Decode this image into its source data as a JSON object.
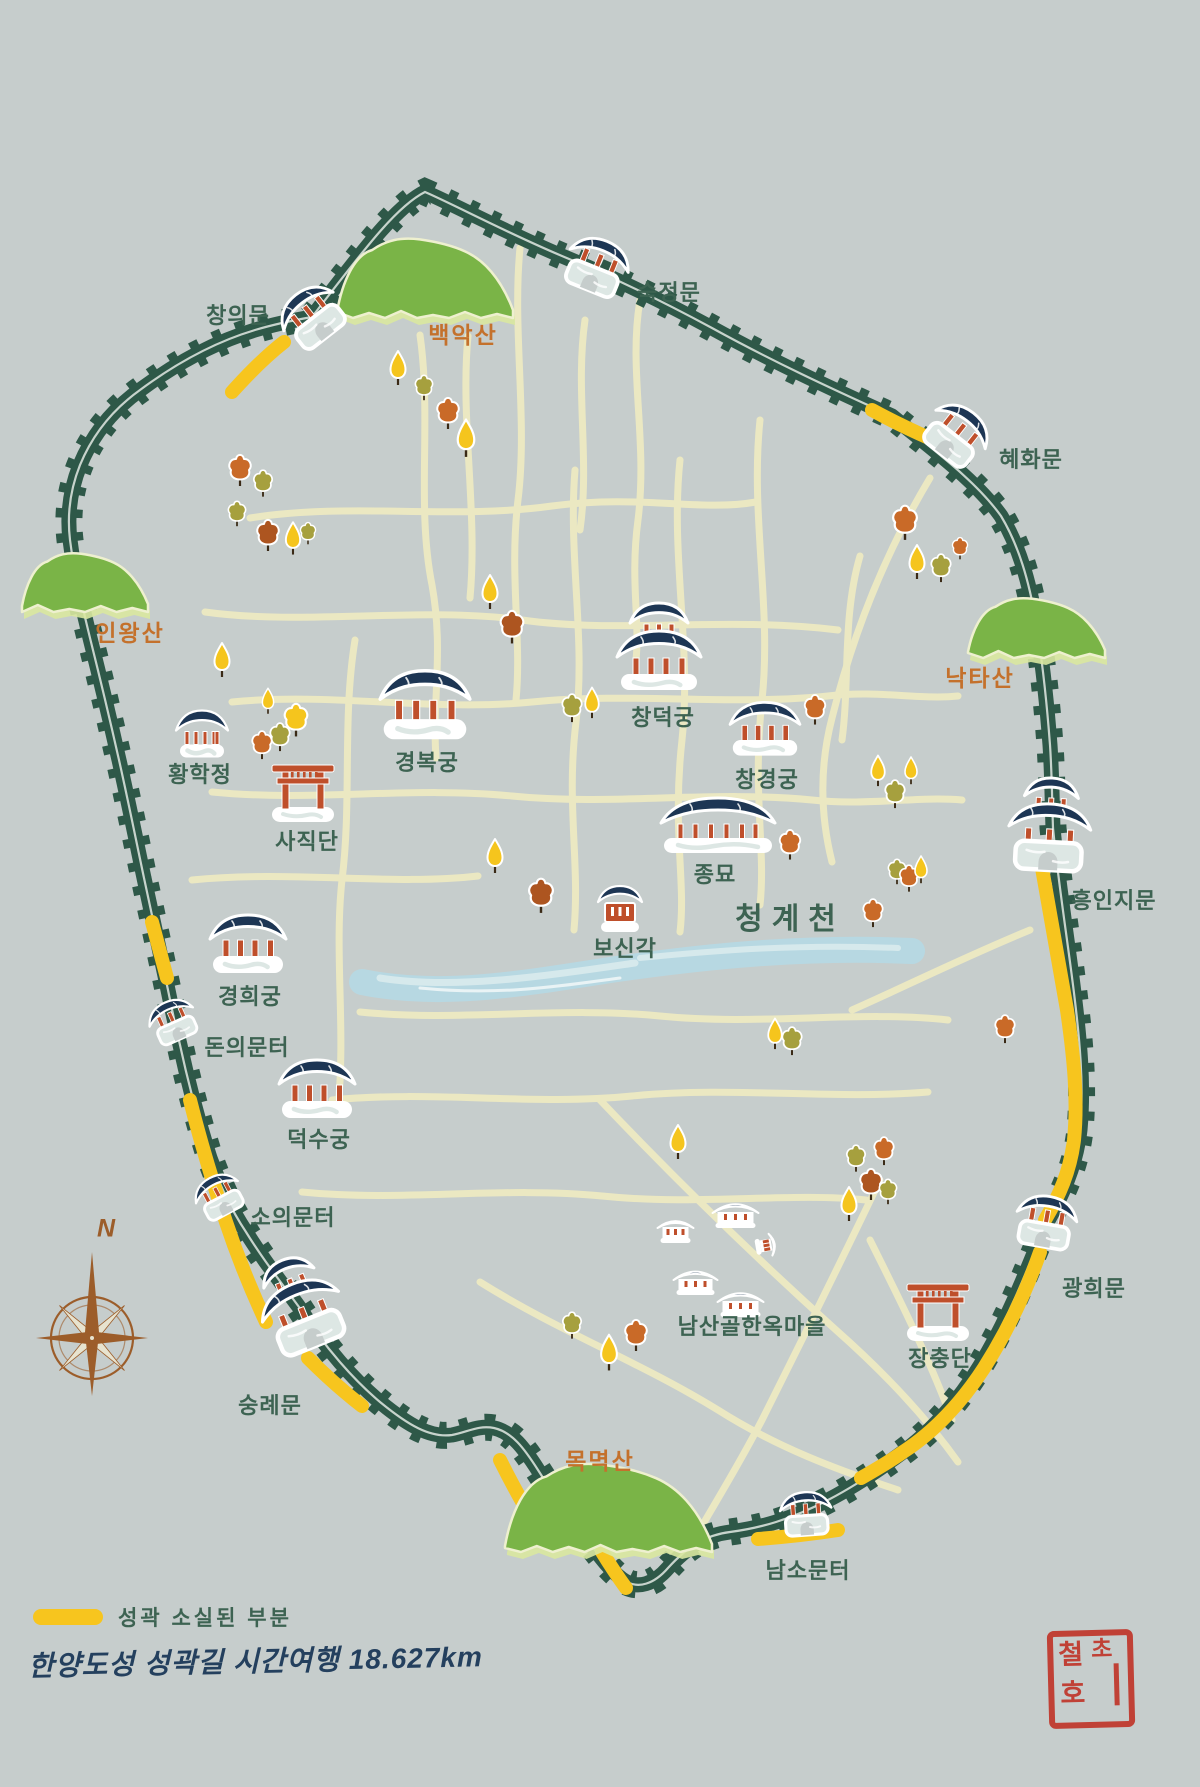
{
  "title": {
    "text": "한양도성 성곽길 시간여행 18.627km"
  },
  "legend": {
    "lost_label": "성곽 소실된 부분"
  },
  "compass": {
    "label": "N"
  },
  "seal": {
    "char1": "철",
    "char2": "초",
    "char3": "호"
  },
  "colors": {
    "bg": "#c6cdcc",
    "wall": "#2e5848",
    "lost": "#f7c51e",
    "road": "#ebe8c2",
    "stream": "#b7d8e2",
    "streamLight": "#d6e9ec",
    "mountain": "#7ab447",
    "mountainLight": "#d9e8a0",
    "mountainEdge": "#eef0cf",
    "roof": "#1d3654",
    "pillar": "#bf4f2b",
    "gateBase": "#dde7e4",
    "labelGreen": "#3d6352",
    "labelOrange": "#c4712c",
    "title": "#24405e",
    "sealRed": "#c03a2e",
    "treeYellow": "#f5c51d",
    "treeOrange": "#c96a28",
    "treeBrown": "#ad5520",
    "treeOlive": "#a6a03e",
    "compassBrown": "#9c5d2a"
  },
  "map": {
    "landmarks": [
      {
        "id": "changuimun",
        "label": "창의문",
        "type": "gate1",
        "icon": {
          "x": 312,
          "y": 316,
          "rot": -38,
          "s": 0.95
        },
        "label_pos": {
          "x": 238,
          "y": 314
        },
        "style": "green"
      },
      {
        "id": "sukjeongmun",
        "label": "숙정문",
        "type": "gate1",
        "icon": {
          "x": 597,
          "y": 266,
          "rot": 22,
          "s": 0.95
        },
        "label_pos": {
          "x": 669,
          "y": 291
        },
        "style": "green"
      },
      {
        "id": "hyehwamun",
        "label": "혜화문",
        "type": "gate1",
        "icon": {
          "x": 957,
          "y": 434,
          "rot": 38,
          "s": 0.95
        },
        "label_pos": {
          "x": 1031,
          "y": 458
        },
        "style": "green"
      },
      {
        "id": "heunginjimun",
        "label": "흥인지문",
        "type": "gate2",
        "icon": {
          "x": 1050,
          "y": 824,
          "rot": 3,
          "s": 1
        },
        "label_pos": {
          "x": 1114,
          "y": 899
        },
        "style": "green"
      },
      {
        "id": "gwanghuimun",
        "label": "광희문",
        "type": "gate1",
        "icon": {
          "x": 1046,
          "y": 1222,
          "rot": 10,
          "s": 0.92
        },
        "label_pos": {
          "x": 1094,
          "y": 1287
        },
        "style": "green"
      },
      {
        "id": "namsomunteo",
        "label": "남소문터",
        "type": "gate1",
        "icon": {
          "x": 806,
          "y": 1514,
          "rot": -4,
          "s": 0.78
        },
        "label_pos": {
          "x": 808,
          "y": 1569
        },
        "style": "green"
      },
      {
        "id": "sungnyemun",
        "label": "숭례문",
        "type": "gate2",
        "icon": {
          "x": 299,
          "y": 1303,
          "rot": -22,
          "s": 1
        },
        "label_pos": {
          "x": 270,
          "y": 1404
        },
        "style": "green"
      },
      {
        "id": "souimunteo",
        "label": "소의문터",
        "type": "gate1",
        "icon": {
          "x": 219,
          "y": 1196,
          "rot": -28,
          "s": 0.72
        },
        "label_pos": {
          "x": 293,
          "y": 1216
        },
        "style": "green"
      },
      {
        "id": "donuimunteo",
        "label": "돈의문터",
        "type": "gate1",
        "icon": {
          "x": 173,
          "y": 1021,
          "rot": -24,
          "s": 0.72
        },
        "label_pos": {
          "x": 247,
          "y": 1046
        },
        "style": "green"
      },
      {
        "id": "gyeongbokgung",
        "label": "경복궁",
        "type": "palace1",
        "icon": {
          "x": 425,
          "y": 705,
          "rot": 0,
          "s": 1.18
        },
        "label_pos": {
          "x": 427,
          "y": 761
        },
        "style": "green"
      },
      {
        "id": "changdeokgung",
        "label": "창덕궁",
        "type": "palace2",
        "icon": {
          "x": 659,
          "y": 646,
          "rot": 0,
          "s": 1
        },
        "label_pos": {
          "x": 663,
          "y": 716
        },
        "style": "green"
      },
      {
        "id": "changgyeonggung",
        "label": "창경궁",
        "type": "palace1",
        "icon": {
          "x": 765,
          "y": 729,
          "rot": 0,
          "s": 0.92
        },
        "label_pos": {
          "x": 767,
          "y": 778
        },
        "style": "green"
      },
      {
        "id": "jongmyo",
        "label": "종묘",
        "type": "jongmyo",
        "icon": {
          "x": 718,
          "y": 825,
          "rot": 0,
          "s": 1
        },
        "label_pos": {
          "x": 715,
          "y": 873
        },
        "style": "green"
      },
      {
        "id": "bosingak",
        "label": "보신각",
        "type": "bosingak",
        "icon": {
          "x": 620,
          "y": 909,
          "rot": 0,
          "s": 1
        },
        "label_pos": {
          "x": 625,
          "y": 947
        },
        "style": "green"
      },
      {
        "id": "cheonggyecheon",
        "label": "청계천",
        "type": null,
        "icon": null,
        "label_pos": {
          "x": 790,
          "y": 916
        },
        "style": "big"
      },
      {
        "id": "gyeonghuigung",
        "label": "경희궁",
        "type": "palace1",
        "icon": {
          "x": 248,
          "y": 944,
          "rot": 0,
          "s": 1
        },
        "label_pos": {
          "x": 250,
          "y": 995
        },
        "style": "green"
      },
      {
        "id": "deoksugung",
        "label": "덕수궁",
        "type": "palace1",
        "icon": {
          "x": 317,
          "y": 1089,
          "rot": 0,
          "s": 1
        },
        "label_pos": {
          "x": 319,
          "y": 1138
        },
        "style": "green"
      },
      {
        "id": "hwanghakjeong",
        "label": "황학정",
        "type": "hwanghak",
        "icon": {
          "x": 202,
          "y": 734,
          "rot": 0,
          "s": 1
        },
        "label_pos": {
          "x": 200,
          "y": 773
        },
        "style": "green"
      },
      {
        "id": "sajikdan",
        "label": "사직단",
        "type": "torii",
        "icon": {
          "x": 303,
          "y": 792,
          "rot": 0,
          "s": 1
        },
        "label_pos": {
          "x": 307,
          "y": 840
        },
        "style": "green"
      },
      {
        "id": "jangchungdan",
        "label": "장충단",
        "type": "torii",
        "icon": {
          "x": 938,
          "y": 1311,
          "rot": 0,
          "s": 1
        },
        "label_pos": {
          "x": 940,
          "y": 1357
        },
        "style": "green"
      },
      {
        "id": "namsangol-hanok-village",
        "label": "남산골한옥마을",
        "type": "village",
        "icon": {
          "x": 718,
          "y": 1252,
          "rot": 0,
          "s": 1
        },
        "label_pos": {
          "x": 752,
          "y": 1325
        },
        "style": "green"
      },
      {
        "id": "bugaksan",
        "label": "백악산",
        "type": null,
        "icon": null,
        "label_pos": {
          "x": 463,
          "y": 333
        },
        "style": "orange"
      },
      {
        "id": "inwangsan",
        "label": "인왕산",
        "type": null,
        "icon": null,
        "label_pos": {
          "x": 130,
          "y": 631
        },
        "style": "orange"
      },
      {
        "id": "naktasan",
        "label": "낙타산",
        "type": null,
        "icon": null,
        "label_pos": {
          "x": 980,
          "y": 676
        },
        "style": "orange"
      },
      {
        "id": "mongmyeoksan",
        "label": "목멱산",
        "type": null,
        "icon": null,
        "label_pos": {
          "x": 600,
          "y": 1459
        },
        "style": "orange"
      }
    ],
    "trees": [
      {
        "x": 398,
        "y": 376,
        "c": "yellow",
        "f": "point",
        "s": 1
      },
      {
        "x": 424,
        "y": 393,
        "c": "olive",
        "f": "round",
        "s": 0.8
      },
      {
        "x": 448,
        "y": 420,
        "c": "orange",
        "f": "round",
        "s": 1
      },
      {
        "x": 466,
        "y": 447,
        "c": "yellow",
        "f": "point",
        "s": 1.1
      },
      {
        "x": 240,
        "y": 477,
        "c": "orange",
        "f": "round",
        "s": 1
      },
      {
        "x": 263,
        "y": 489,
        "c": "olive",
        "f": "round",
        "s": 0.85
      },
      {
        "x": 237,
        "y": 519,
        "c": "olive",
        "f": "round",
        "s": 0.8
      },
      {
        "x": 268,
        "y": 542,
        "c": "brown",
        "f": "round",
        "s": 1
      },
      {
        "x": 293,
        "y": 546,
        "c": "yellow",
        "f": "point",
        "s": 0.95
      },
      {
        "x": 308,
        "y": 538,
        "c": "olive",
        "f": "round",
        "s": 0.7
      },
      {
        "x": 222,
        "y": 668,
        "c": "yellow",
        "f": "point",
        "s": 1
      },
      {
        "x": 268,
        "y": 707,
        "c": "yellow",
        "f": "point",
        "s": 0.75
      },
      {
        "x": 296,
        "y": 727,
        "c": "yellow",
        "f": "round",
        "s": 1.05
      },
      {
        "x": 280,
        "y": 743,
        "c": "olive",
        "f": "round",
        "s": 0.9
      },
      {
        "x": 262,
        "y": 751,
        "c": "orange",
        "f": "round",
        "s": 0.9
      },
      {
        "x": 490,
        "y": 600,
        "c": "yellow",
        "f": "point",
        "s": 1
      },
      {
        "x": 512,
        "y": 634,
        "c": "brown",
        "f": "round",
        "s": 1.05
      },
      {
        "x": 572,
        "y": 714,
        "c": "olive",
        "f": "round",
        "s": 0.9
      },
      {
        "x": 592,
        "y": 710,
        "c": "yellow",
        "f": "point",
        "s": 0.9
      },
      {
        "x": 815,
        "y": 716,
        "c": "orange",
        "f": "round",
        "s": 0.95
      },
      {
        "x": 905,
        "y": 530,
        "c": "orange",
        "f": "round",
        "s": 1.1
      },
      {
        "x": 917,
        "y": 570,
        "c": "yellow",
        "f": "point",
        "s": 1
      },
      {
        "x": 941,
        "y": 574,
        "c": "olive",
        "f": "round",
        "s": 0.9
      },
      {
        "x": 960,
        "y": 553,
        "c": "orange",
        "f": "round",
        "s": 0.7
      },
      {
        "x": 878,
        "y": 778,
        "c": "yellow",
        "f": "point",
        "s": 0.9
      },
      {
        "x": 895,
        "y": 800,
        "c": "olive",
        "f": "round",
        "s": 0.9
      },
      {
        "x": 911,
        "y": 777,
        "c": "yellow",
        "f": "point",
        "s": 0.8
      },
      {
        "x": 897,
        "y": 877,
        "c": "olive",
        "f": "round",
        "s": 0.8
      },
      {
        "x": 909,
        "y": 884,
        "c": "orange",
        "f": "round",
        "s": 0.85
      },
      {
        "x": 921,
        "y": 876,
        "c": "yellow",
        "f": "point",
        "s": 0.8
      },
      {
        "x": 873,
        "y": 919,
        "c": "orange",
        "f": "round",
        "s": 0.9
      },
      {
        "x": 495,
        "y": 864,
        "c": "yellow",
        "f": "point",
        "s": 1
      },
      {
        "x": 541,
        "y": 903,
        "c": "brown",
        "f": "round",
        "s": 1.1
      },
      {
        "x": 790,
        "y": 851,
        "c": "orange",
        "f": "round",
        "s": 0.95
      },
      {
        "x": 775,
        "y": 1041,
        "c": "yellow",
        "f": "point",
        "s": 0.9
      },
      {
        "x": 792,
        "y": 1047,
        "c": "olive",
        "f": "round",
        "s": 0.9
      },
      {
        "x": 678,
        "y": 1150,
        "c": "yellow",
        "f": "point",
        "s": 1
      },
      {
        "x": 856,
        "y": 1164,
        "c": "olive",
        "f": "round",
        "s": 0.85
      },
      {
        "x": 884,
        "y": 1157,
        "c": "orange",
        "f": "round",
        "s": 0.9
      },
      {
        "x": 871,
        "y": 1191,
        "c": "brown",
        "f": "round",
        "s": 1
      },
      {
        "x": 888,
        "y": 1197,
        "c": "olive",
        "f": "round",
        "s": 0.8
      },
      {
        "x": 849,
        "y": 1212,
        "c": "yellow",
        "f": "point",
        "s": 1
      },
      {
        "x": 1005,
        "y": 1035,
        "c": "orange",
        "f": "round",
        "s": 0.9
      },
      {
        "x": 572,
        "y": 1331,
        "c": "olive",
        "f": "round",
        "s": 0.85
      },
      {
        "x": 609,
        "y": 1361,
        "c": "yellow",
        "f": "point",
        "s": 1.05
      },
      {
        "x": 636,
        "y": 1342,
        "c": "orange",
        "f": "round",
        "s": 1
      }
    ]
  }
}
